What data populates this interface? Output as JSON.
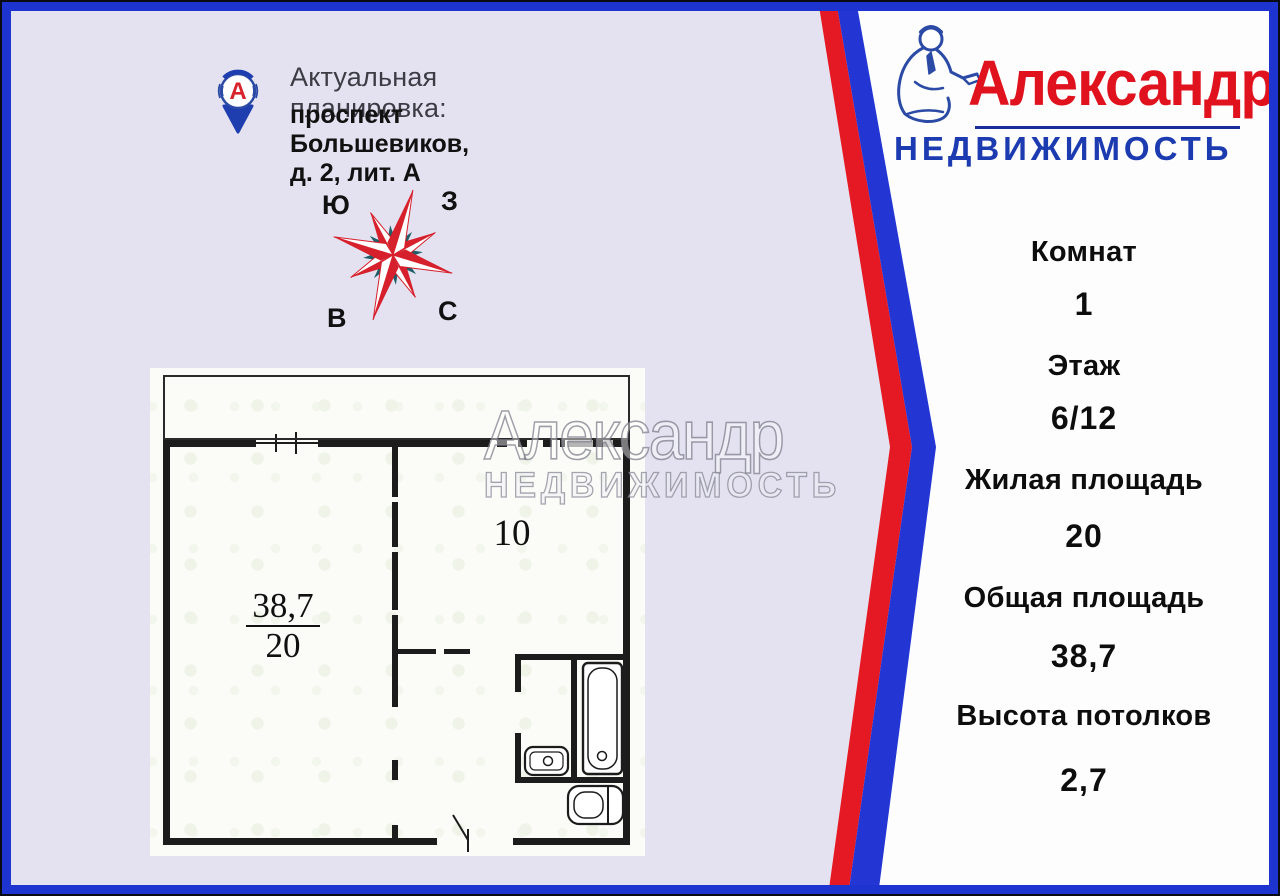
{
  "header": {
    "title": "Актуальная планировка:",
    "address": "проспект Большевиков, д. 2, лит. А"
  },
  "compass": {
    "top_left": "Ю",
    "top_right": "З",
    "bottom_left": "В",
    "bottom_right": "С"
  },
  "floor_plan": {
    "room1_area": "38,7",
    "room1_sub": "20",
    "room2_area": "10"
  },
  "watermark": {
    "line1": "Александр",
    "line2": "НЕДВИЖИМОСТЬ"
  },
  "logo": {
    "name": "Александр",
    "subtitle": "НЕДВИЖИМОСТЬ",
    "letter": "А"
  },
  "details": [
    {
      "label": "Комнат",
      "value": "1"
    },
    {
      "label": "Этаж",
      "value": "6/12"
    },
    {
      "label": "Жилая площадь",
      "value": "20"
    },
    {
      "label": "Общая площадь",
      "value": "38,7"
    },
    {
      "label": "Высота потолков",
      "value": "2,7"
    }
  ],
  "colors": {
    "accent_red": "#e0121e",
    "accent_blue": "#1e34d0",
    "panel_lavender": "#e4e2f0",
    "panel_white": "#fdfdfe",
    "wall_black": "#1c1c1c"
  }
}
